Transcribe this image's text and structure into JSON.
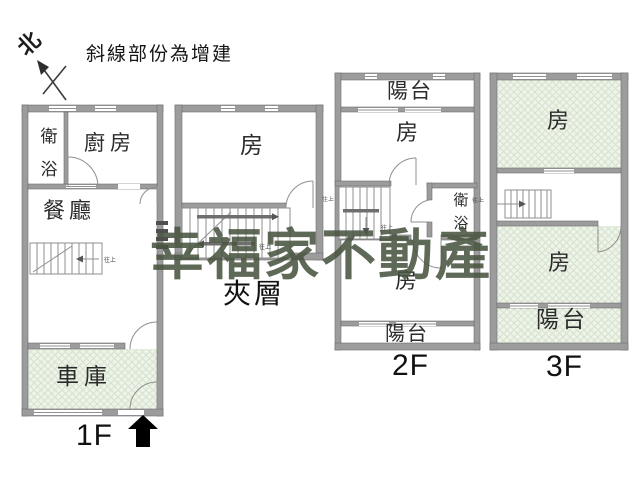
{
  "compass": {
    "label": "北"
  },
  "legend": {
    "note": "斜線部份為增建"
  },
  "watermark": {
    "text": "幸福家不動產",
    "color": "#4a5540"
  },
  "notes": {
    "stairs_up": "往上"
  },
  "palette": {
    "wall": "#9c9c9c",
    "addition_fill": "#eff4ea",
    "line": "#8f8f8f"
  },
  "plans": {
    "f1": {
      "floor_label": "1F",
      "bathroom": "衛浴",
      "kitchen": "廚房",
      "dining": "餐廳",
      "garage": "車庫"
    },
    "mezzanine": {
      "floor_label": "夾層",
      "room": "房"
    },
    "f2": {
      "floor_label": "2F",
      "balcony_top": "陽台",
      "room_top": "房",
      "bathroom": "衛浴",
      "room_bottom": "房",
      "balcony_bottom": "陽台"
    },
    "f3": {
      "floor_label": "3F",
      "room_top": "房",
      "room_bottom": "房",
      "balcony": "陽台"
    }
  }
}
